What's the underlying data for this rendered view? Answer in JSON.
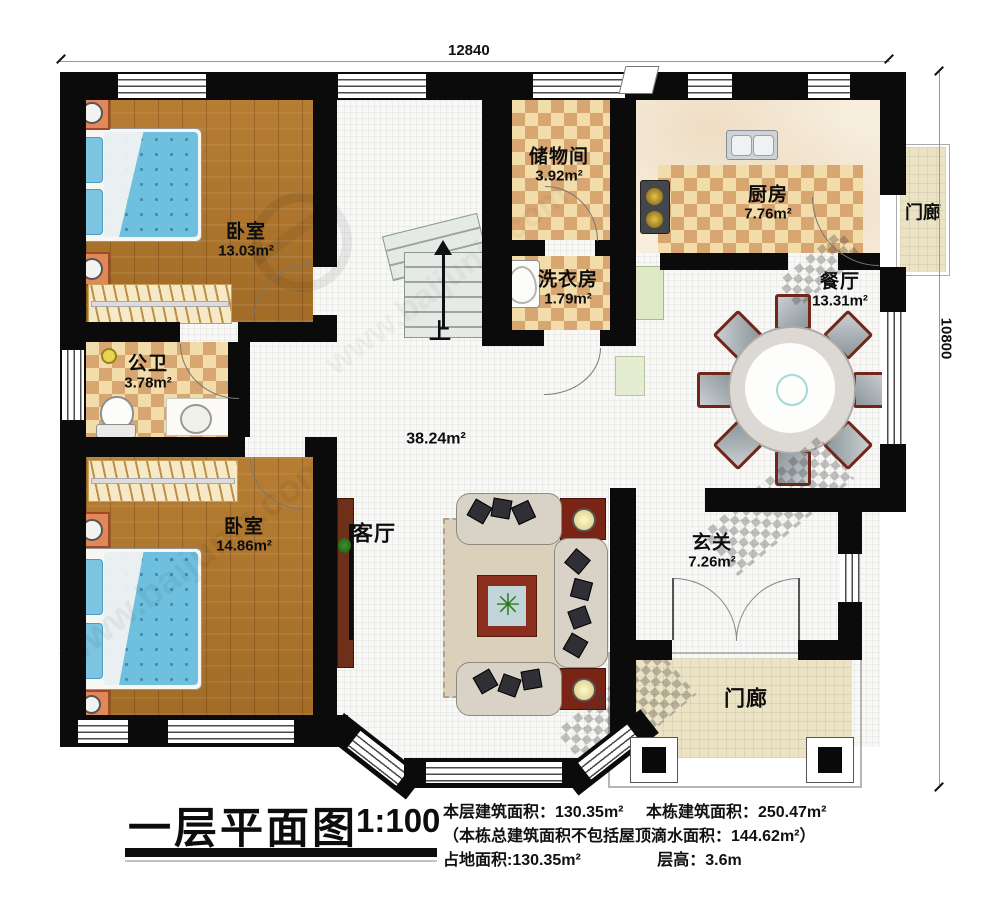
{
  "dims": {
    "width": "12840",
    "height": "10800"
  },
  "rooms": [
    {
      "name": "卧室",
      "area": "13.03m²"
    },
    {
      "name": "储物间",
      "area": "3.92m²"
    },
    {
      "name": "厨房",
      "area": "7.76m²"
    },
    {
      "name": "门廊",
      "area": ""
    },
    {
      "name": "餐厅",
      "area": "13.31m²"
    },
    {
      "name": "洗衣房",
      "area": "1.79m²"
    },
    {
      "name": "公卫",
      "area": "3.78m²"
    },
    {
      "name": "卧室",
      "area": "14.86m²"
    },
    {
      "name": "客厅",
      "area": "38.24m²"
    },
    {
      "name": "玄关",
      "area": "7.26m²"
    },
    {
      "name": "门廊",
      "area": ""
    }
  ],
  "stairs": {
    "up_label": "上"
  },
  "title_block": {
    "title": "一层平面图",
    "scale": "1:100",
    "info1a": "本层建筑面积：130.35m²",
    "info1b": "本栋建筑面积：250.47m²",
    "info2": "（本栋总建筑面积不包括屋顶滴水面积：144.62m²）",
    "info3a": "占地面积:130.35m²",
    "info3b": "层高：3.6m"
  },
  "watermark": {
    "url": "www.baijunjz.com"
  },
  "colors": {
    "wall": "#0b0b0b",
    "wood_floor": "#ad742d",
    "tile_light": "#f2dcaa",
    "tile_dark": "#d7a671",
    "bed_blue": "#6fc0de",
    "nightstand_orange": "#e08858",
    "table_wood_red": "#7a2416",
    "porch_tan": "#ebe3c3"
  }
}
